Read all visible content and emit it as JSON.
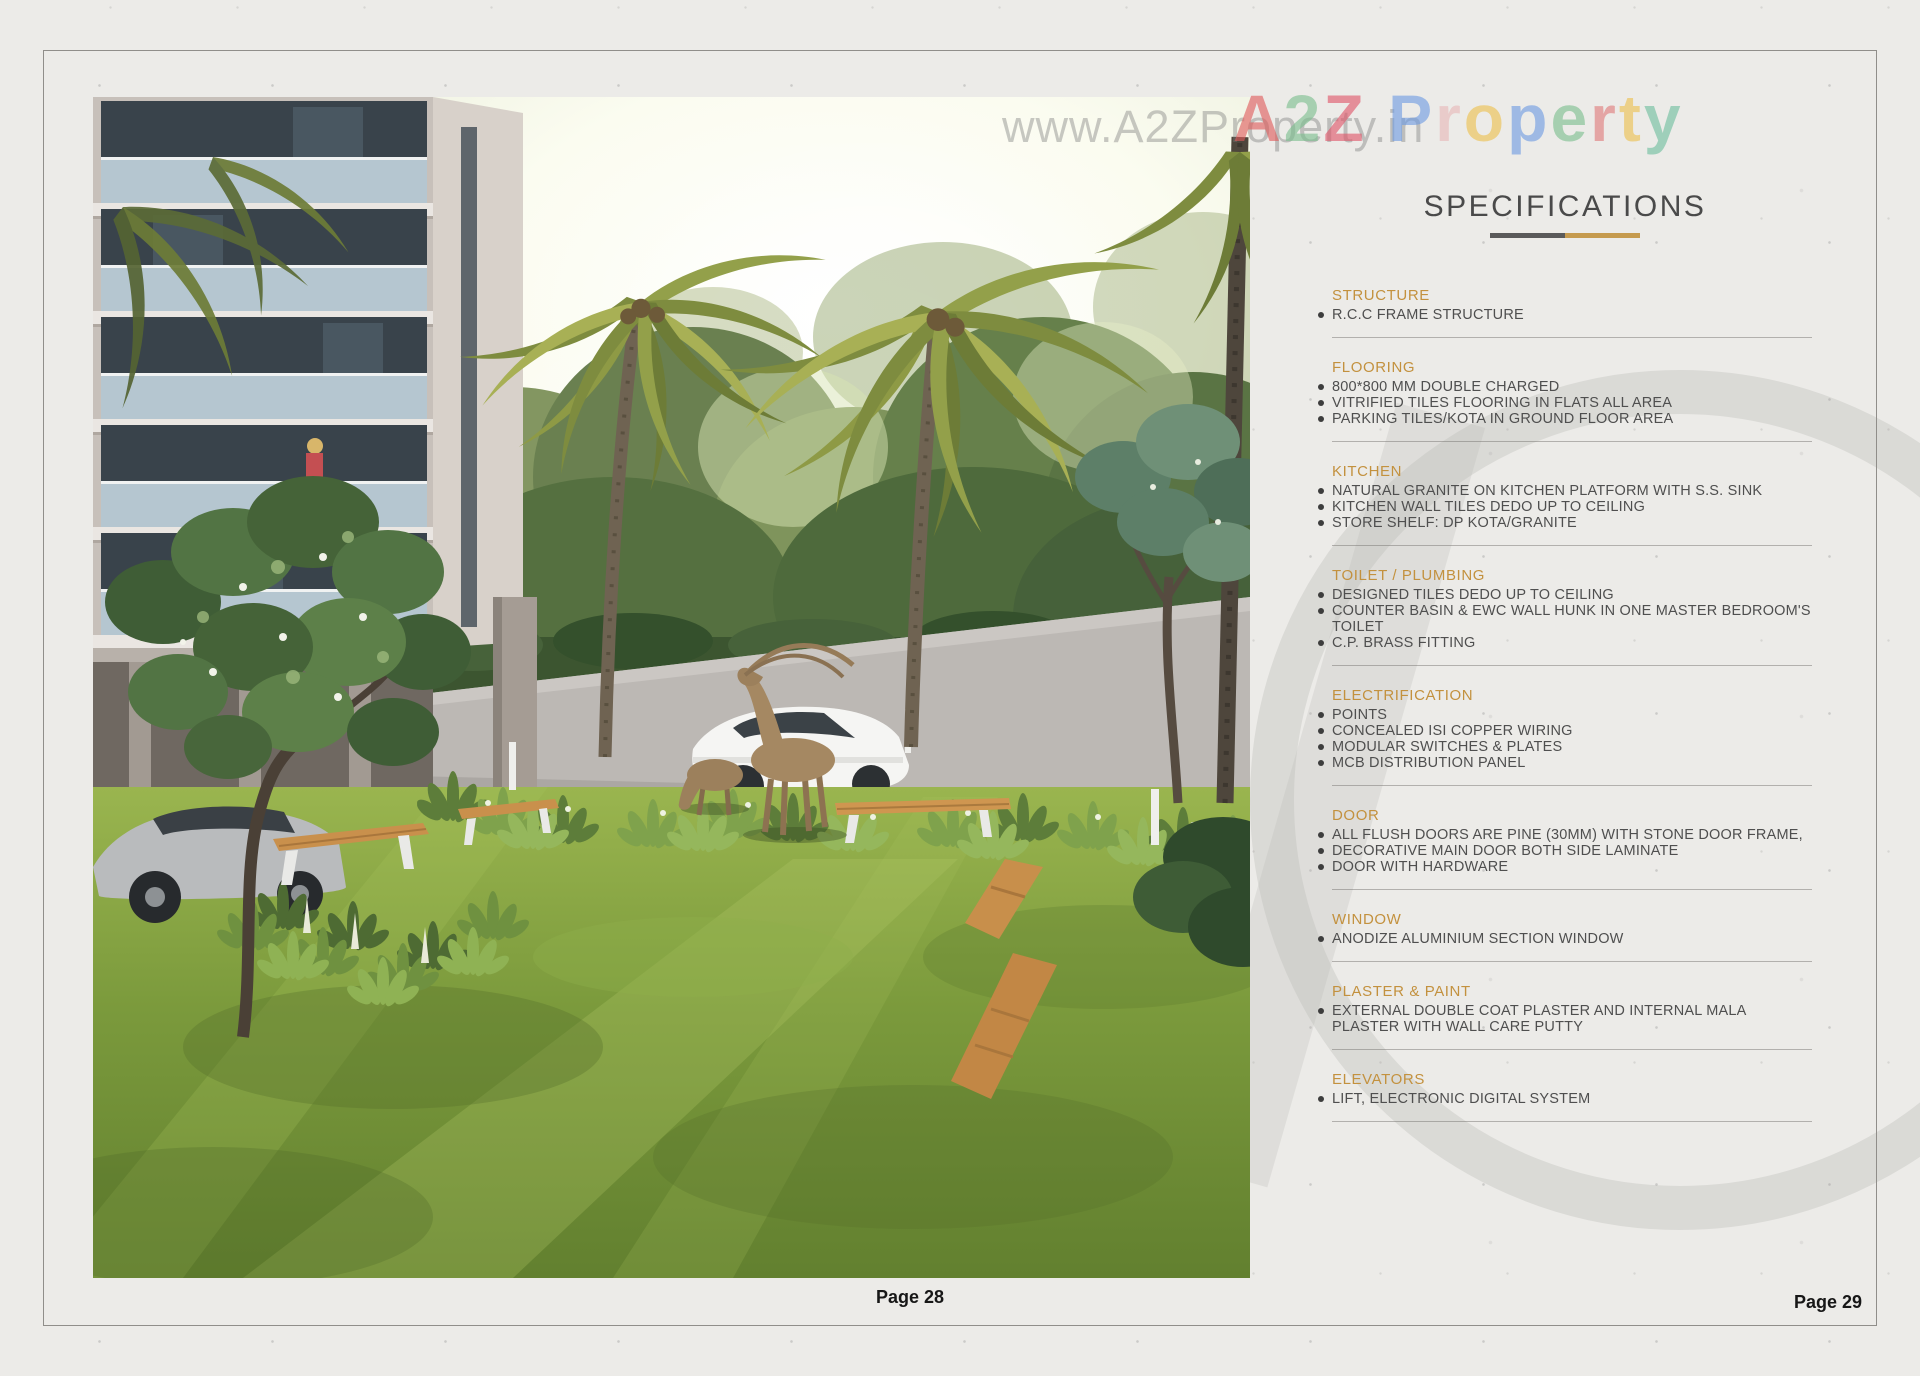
{
  "page": {
    "left_page_label": "Page 28",
    "right_page_label": "Page 29"
  },
  "watermark": {
    "url_text": "www.A2ZProperty.in",
    "brand_letters": [
      {
        "ch": "A",
        "color": "#e05c5c"
      },
      {
        "ch": "2",
        "color": "#7cbf8e"
      },
      {
        "ch": "Z",
        "color": "#e0566a"
      },
      {
        "ch": " ",
        "color": "#999999"
      },
      {
        "ch": "P",
        "color": "#6f9ce3"
      },
      {
        "ch": "r",
        "color": "#e8b9b9"
      },
      {
        "ch": "o",
        "color": "#edc14f"
      },
      {
        "ch": "p",
        "color": "#6f9ce3"
      },
      {
        "ch": "e",
        "color": "#7cbf8e"
      },
      {
        "ch": "r",
        "color": "#e07b7b"
      },
      {
        "ch": "t",
        "color": "#edc14f"
      },
      {
        "ch": "y",
        "color": "#6fbf9e"
      }
    ]
  },
  "specifications": {
    "title": "SPECIFICATIONS",
    "colors": {
      "heading": "#c3913e",
      "underline_left": "#5a5a5a",
      "underline_right": "#c59a4e"
    },
    "sections": [
      {
        "heading": "STRUCTURE",
        "items": [
          "R.C.C FRAME STRUCTURE"
        ]
      },
      {
        "heading": "FLOORING",
        "items": [
          "800*800 MM DOUBLE CHARGED",
          "VITRIFIED TILES FLOORING IN FLATS ALL AREA",
          "PARKING TILES/KOTA IN GROUND FLOOR AREA"
        ]
      },
      {
        "heading": "KITCHEN",
        "items": [
          "NATURAL GRANITE ON KITCHEN PLATFORM WITH S.S. SINK",
          "KITCHEN WALL TILES DEDO UP TO CEILING",
          "STORE SHELF: DP KOTA/GRANITE"
        ]
      },
      {
        "heading": "TOILET / PLUMBING",
        "items": [
          "DESIGNED TILES DEDO UP TO CEILING",
          "COUNTER BASIN & EWC WALL HUNK IN ONE MASTER BEDROOM'S TOILET",
          "C.P. BRASS FITTING"
        ]
      },
      {
        "heading": "ELECTRIFICATION",
        "items": [
          "POINTS",
          "CONCEALED ISI COPPER WIRING",
          "MODULAR SWITCHES & PLATES",
          "MCB DISTRIBUTION PANEL"
        ]
      },
      {
        "heading": "DOOR",
        "items": [
          "ALL FLUSH DOORS ARE PINE (30MM) WITH STONE DOOR FRAME,",
          "DECORATIVE MAIN DOOR BOTH SIDE LAMINATE",
          "DOOR WITH HARDWARE"
        ]
      },
      {
        "heading": "WINDOW",
        "items": [
          "ANODIZE ALUMINIUM SECTION WINDOW"
        ]
      },
      {
        "heading": "PLASTER & PAINT",
        "items": [
          "EXTERNAL DOUBLE COAT PLASTER AND INTERNAL MALA PLASTER WITH WALL CARE PUTTY"
        ]
      },
      {
        "heading": "ELEVATORS",
        "items": [
          "LIFT, ELECTRONIC DIGITAL SYSTEM"
        ]
      }
    ]
  }
}
